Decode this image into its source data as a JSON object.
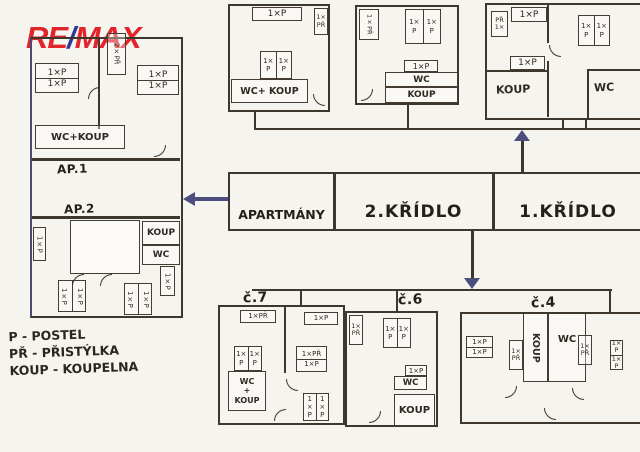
{
  "logo": {
    "re": "RE",
    "slash": "/",
    "max": "MAX"
  },
  "colors": {
    "ink": "#3e372e",
    "arrow_navy": "#4c4e7d",
    "logo_red": "#e2242b",
    "logo_blue": "#2b3990",
    "paper": "#f6f4ef"
  },
  "overview": {
    "cells": [
      "APARTMÁNY",
      "2.KŘÍDLO",
      "1.KŘÍDLO"
    ]
  },
  "legend": {
    "line1": "P - POSTEL",
    "line2": "PŘ - PŘISTÝLKA",
    "line3": "KOUP - KOUPELNA"
  },
  "apartments": {
    "ap1": {
      "label": "AP.1",
      "bed1": "1×P",
      "bed2": "1×P",
      "bed3": "1×P",
      "bed4": "1×P",
      "extra": "2×PŘ",
      "bath": "WC+KOUP"
    },
    "ap2": {
      "label": "AP.2",
      "koup": "KOUP",
      "wc": "WC",
      "bed_left": "1×P",
      "bed_bl1": "1×P",
      "bed_bl2": "1×P",
      "bed_br1": "1×P",
      "bed_br2": "1×P",
      "bed_right": "1×P"
    }
  },
  "top_plans": {
    "t1": {
      "bed_top": "1×P",
      "extra": "1×PŘ",
      "bed_mid1": "1×P",
      "bed_mid2": "1×P",
      "bath": "WC+ KOUP"
    },
    "t2": {
      "extra": "1×PŘ",
      "bed_top1": "1×P",
      "bed_top2": "1×P",
      "bed_mid": "1×P",
      "wc": "WC",
      "koup": "KOUP"
    },
    "t3": {
      "extra": "PŘ 1×",
      "bed_top": "1×P",
      "bed_r1": "1×P",
      "bed_r2": "1×P",
      "bed_mid": "1×P",
      "koup": "KOUP",
      "wc": "WC"
    }
  },
  "bottom_plans": {
    "b7": {
      "name": "č.7",
      "extra_top": "1×PŘ",
      "bed_top": "1×P",
      "bed_l1": "1×P",
      "bed_l2": "1×P",
      "mid1": "1×PŘ",
      "mid2": "1×P",
      "bath1": "WC",
      "bath2": "+",
      "bath3": "KOUP",
      "bed_b1": "1×P",
      "bed_b2": "1×P"
    },
    "b6": {
      "name": "č.6",
      "extra": "1×PŘ",
      "bed_t1": "1×P",
      "bed_t2": "1×P",
      "bed_mid": "1×P",
      "wc": "WC",
      "koup": "KOUP"
    },
    "b4": {
      "name": "č.4",
      "bed_l1": "1×P",
      "bed_l2": "1×P",
      "extra_l": "1×PŘ",
      "koup": "KOUP",
      "wc": "WC",
      "extra_r": "1×PŘ",
      "bed_f1": "1×P",
      "bed_f2": "1×P"
    }
  }
}
